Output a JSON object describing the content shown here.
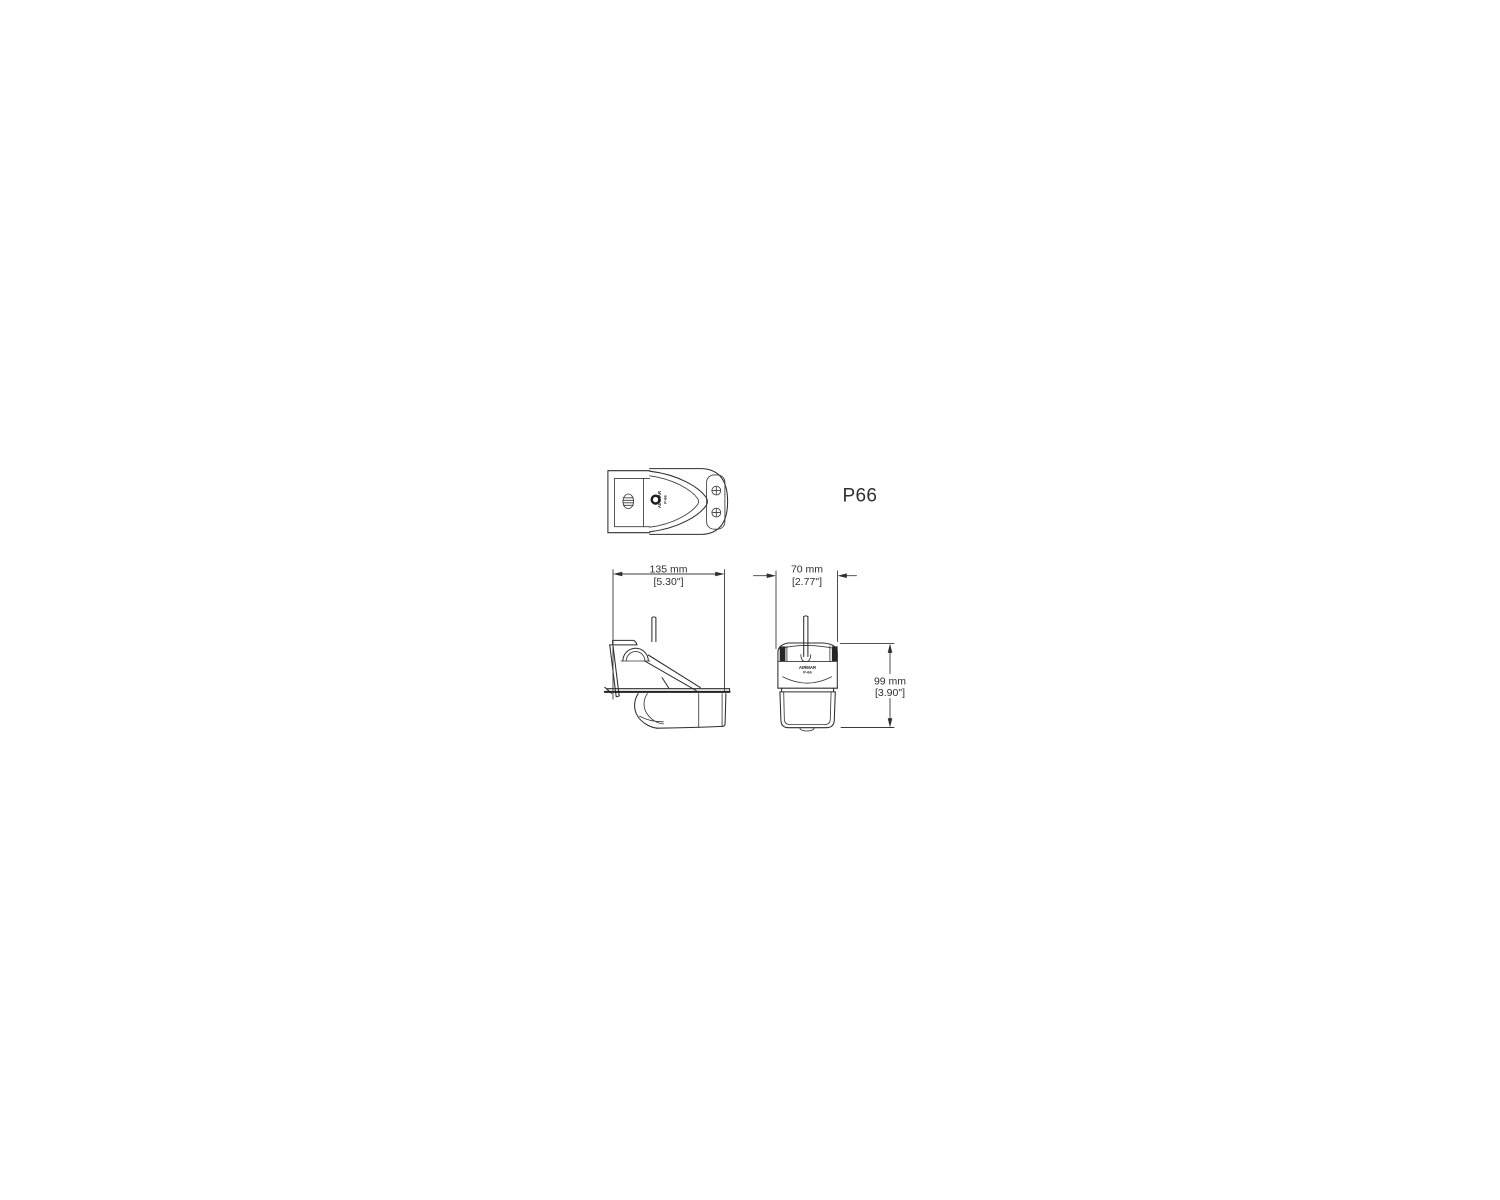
{
  "page": {
    "background": "#ffffff",
    "line_color": "#2e2e2e",
    "dimension_color": "#3a3a3a"
  },
  "part_label": "P66",
  "device": {
    "brand": "AIRMAR",
    "model": "P-66"
  },
  "dimensions": {
    "width": {
      "metric": "135 mm",
      "imperial": "[5.30\"]"
    },
    "depth": {
      "metric": "70 mm",
      "imperial": "[2.77\"]"
    },
    "height": {
      "metric": "99 mm",
      "imperial": "[3.90\"]"
    }
  }
}
